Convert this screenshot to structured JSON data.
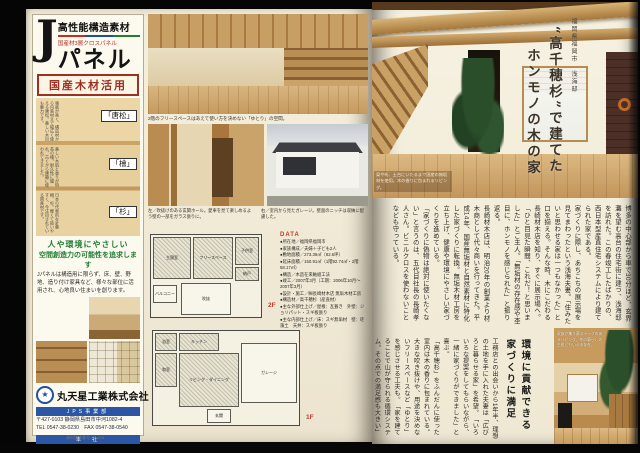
{
  "colors": {
    "accent_red": "#c0392b",
    "bar_blue": "#2a56a5",
    "slogan_green": "#1e7e34",
    "wood": "#caa36b"
  },
  "left_page": {
    "ad": {
      "big_letter": "J",
      "headline": "高性能構造素材",
      "subheadline": "国産材3層クロスパネル",
      "product_name": "パネル",
      "badge": "国産木材活用",
      "wood_labels": [
        "「唐松」",
        "「檜」",
        "「杉」"
      ],
      "wood_notes": [
        "強度が高く、構造材から内装材まで幅広く使える唐松。美しい木目も魅力です。",
        "美しい木肌と香りが特長の檜。耐久性に優れ、古くから建築に使われてきました。",
        "日本の代表的な針葉樹、杉。軽くて扱いやすく、今注目されている国産材です。"
      ],
      "slogan_line1": "人や環境にやさしい",
      "slogan_line2": "空間創造力の可能性を追求します",
      "body": "Jパネルは構造用に限らず、床、壁、野地、造り付け家具など、様々な部位に活用され、心地良い住まいを創ります。",
      "logo_glyph": "★",
      "company_name": "丸天星工業株式会社",
      "dept1": "JPS事業部",
      "dept1_addr": "〒427-0103 静岡県島田市中河1082-4",
      "dept1_tel": "TEL 0547-38-0230　FAX 0547-38-0540",
      "dept2": "本　社",
      "dept2_addr": "〒427-0102 静岡県島田市大柳463",
      "dept2_tel": "TEL 0547-36-4311　FAX 0547-38-4314",
      "url": "http://www.marutenboshi.co.jp",
      "request_no": "資料請求番号 No.428"
    },
    "article": {
      "top_caption": "2階のフリースペースはあえて使い方を決めない「ゆとり」の空間。",
      "caption_left": "左／吹抜けのある玄関ホール。愛車を見て楽しめるよう壁の一部をガラス張りに。",
      "caption_right": "右／室内から見たガレージ。壁面のニッチは収納に配慮した。",
      "plan2f_label": "2F",
      "plan1f_label": "1F",
      "rooms_2f": [
        "主寝室",
        "フリースペース",
        "子供室",
        "納戸",
        "吹抜",
        "バルコニー"
      ],
      "rooms_1f": [
        "キッチン",
        "浴室",
        "和室",
        "リビング・ダイニング",
        "ガレージ",
        "玄関"
      ],
      "data_heading": "DATA",
      "data_items": [
        "●所在地／福岡県福岡市",
        "●家族構成／夫婦＋子ども2人",
        "●敷地面積／273.36㎡（82.6坪）",
        "●延床面積／150.91㎡（1階92.74㎡・2階58.17㎡）",
        "●構造／木造在来軸組工法",
        "●竣工／2007年3月（工期：2006年10月～2007年3月）",
        "●設計・施工／㈱長崎材木店 無垢木材工房",
        "●構造材／高千穂杉（産直材）",
        "●主な外部仕上げ／屋根：瓦葺き　外壁：ジョリパット・スギ板張り",
        "●主な内部仕上げ／床：スギ無垢材　壁：珪藻土　天井：スギ板張り"
      ]
    }
  },
  "right_page": {
    "location_label": "福岡県福岡市　浅海邸",
    "title_col1": "“高千穂杉”で建てた",
    "title_col2": "ホンモノの木の家",
    "photo_caption": "梁や桁、土台にいたるまで国産の無垢材を使用。木の香りに包まれるリビング。",
    "body_text": "博多の中心部から車で30分ほど、玄界灘を望む高台の住宅街に建つ、浅海邸を訪れた。この春竣工したばかりの、西日本型産直住宅システムにより建てられた家である。\n家づくりに際し、あちこちの展示場を見てまわったという浅海夫妻。「住みたいと思わせる家は一つもなかった」と口を揃える。そんな時、木にこだわる長崎材木店を知り、すぐに展示場へ。「ひと目見た瞬間、これだ！と思いました」とご主人。「無垢材の存在感や杢目に、ホンモノを感じられた」と振り返る。\n長崎材木店は、明治20年の創業より材木商として代々商いを行ってきた。平成14年、国産無垢材と自然素材に特化した家づくりに転換。無垢木材工房を立ち上げ、健康や環境にやさしい家づくりを進めている。\n「家づくりに偽物は絶対に使いたくない」と言うのは、五代目社長の長崎孝人さん。ビニルクロスを使わないことなども守っている。",
    "subheading": "環境に貢献できる\n家づくりに満足",
    "body_text2": "工務店との出会いから1年半、理想の土地を手に入れた夫妻は「広びろと暮らせる家」を希望。「いろいろな提案をしてもらいながら、一緒に家づくりができました」と喜ぶ。\n「高千穂杉」をふんだんに使った室内は木の香りに包まれている。大きな吹き抜けや、用途を決めないフリースペースなど「ゆとり」を感じさせる工夫も。「家を建てることで山が守られる循環システム。その点での満足感も大きい」とご主人は話してくれた。",
    "bottom_caption": "家族が集う薪ストーブのあるリビング。冬の暮らしの主役ともいえる存在。"
  }
}
